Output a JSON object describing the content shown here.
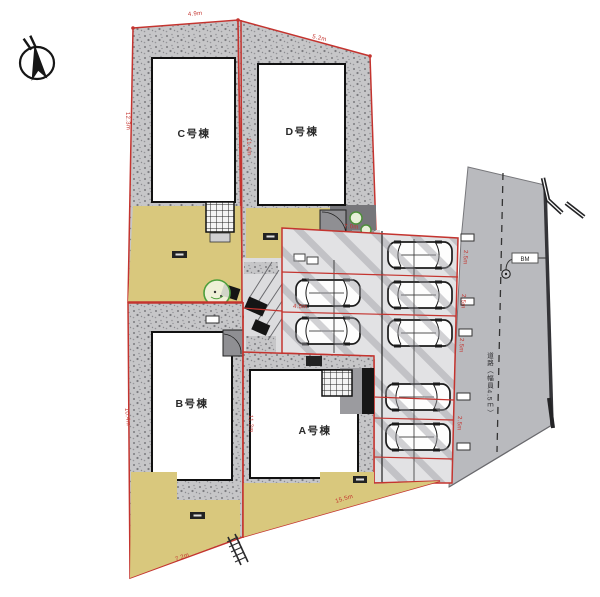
{
  "buildings": {
    "c": "C号棟",
    "d": "D号棟",
    "b": "B号棟",
    "a": "A号棟"
  },
  "road": {
    "label": "道路（幅員4.5ｍ）",
    "benchmark": "BM"
  },
  "dims": [
    "4.9m",
    "5.2m",
    "12.3m",
    "10.4m",
    "11.4m",
    "11.2m",
    "7.2m",
    "15.5m",
    "7.0m",
    "4.5m",
    "2.5m",
    "2.5m",
    "2.5m",
    "2.5m"
  ],
  "colors": {
    "boundary_red": "#c4342f",
    "yard_tan": "#d9c87d",
    "road_gray": "#b9babe",
    "gravel_gray": "#c6c6c8",
    "parking_gray": "#e2e2e4",
    "tree_green": "#4e9f3c"
  }
}
